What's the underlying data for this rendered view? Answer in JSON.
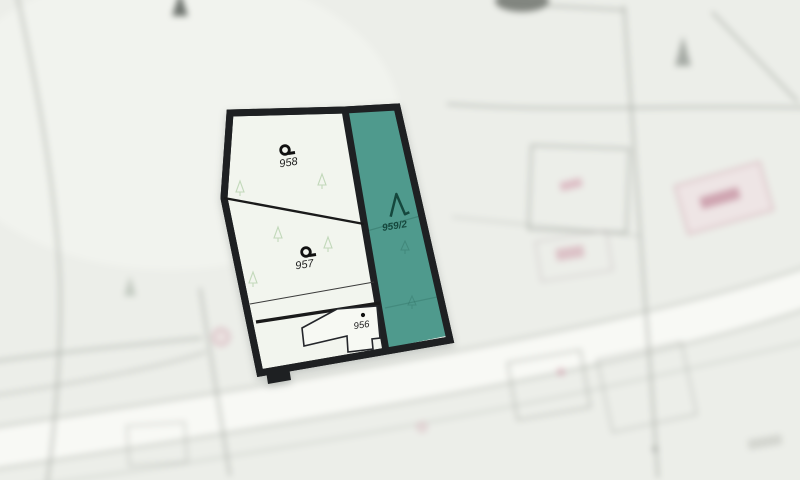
{
  "colors": {
    "background": "#eceee9",
    "parcel_fill": "#f2f5ee",
    "outline": "#1e2022",
    "forest_fill": "#4f9a8d",
    "forest_label": "#15473d",
    "label": "#1c1c1c",
    "building_fill": "#f7f9f3",
    "faded_pink": "#dda3b1",
    "faint_tree_green": "#b7d2ae",
    "road_fill": "#f8f9f5",
    "bg_line": "#a3a7a0"
  },
  "parcels": [
    {
      "label": "958"
    },
    {
      "label": "957"
    },
    {
      "label": "956"
    },
    {
      "label": "959/2"
    }
  ],
  "underlay": {
    "text": "258"
  }
}
